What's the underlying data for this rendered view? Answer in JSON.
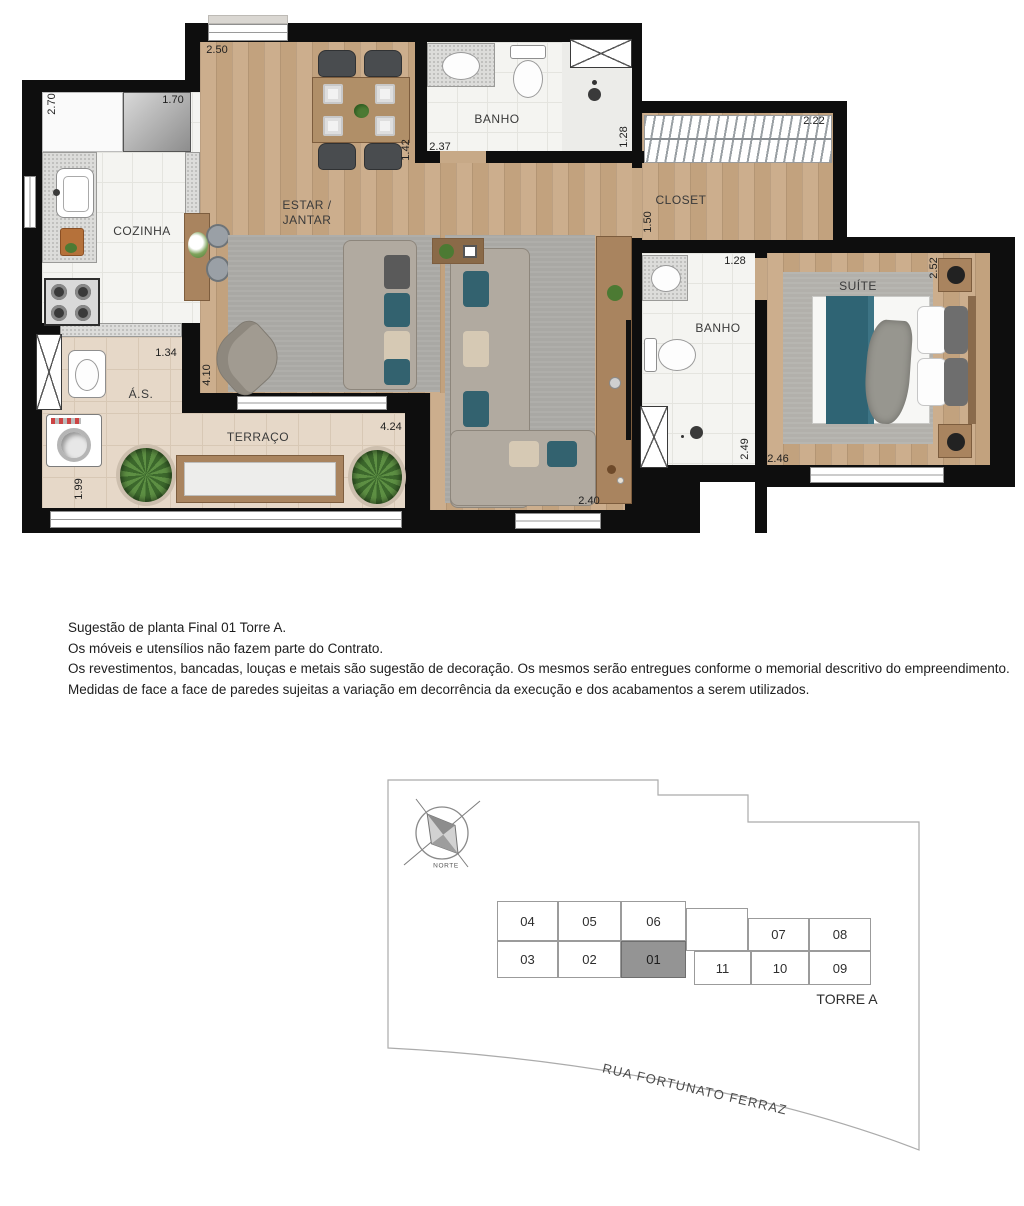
{
  "floor_plan": {
    "rooms": {
      "cozinha": "COZINHA",
      "estar_line1": "ESTAR /",
      "estar_line2": "JANTAR",
      "banho_social": "BANHO",
      "closet": "CLOSET",
      "banho_suite": "BANHO",
      "suite": "SUÍTE",
      "area_servico": "Á.S.",
      "terraco": "TERRAÇO"
    },
    "dimensions": {
      "estar_top": "2.50",
      "cozinha_left": "2.70",
      "cozinha_top": "1.70",
      "estar_right": "1.42",
      "banho_social_width": "2.37",
      "banho_social_depth": "1.28",
      "closet_width": "2.22",
      "closet_door": "1.50",
      "banho_suite_width": "1.28",
      "suite_depth": "2.52",
      "as_width": "1.34",
      "living_depth": "4.10",
      "terraco_width": "4.24",
      "living_width": "2.40",
      "banho_suite_depth": "2.49",
      "suite_width": "2.46",
      "terraco_depth": "1.99"
    },
    "colors": {
      "wall": "#0e0e0e",
      "wood_floor": "#c9ab89",
      "tile_floor": "#f4f4f1",
      "terrace_floor": "#e6d8c8",
      "rug": "#a9a8a4",
      "accent_teal": "#2f6474"
    }
  },
  "disclaimer": {
    "lines": [
      "Sugestão de planta Final 01 Torre A.",
      "Os móveis e utensílios não fazem parte do Contrato.",
      "Os revestimentos, bancadas, louças e metais são sugestão de decoração. Os mesmos serão entregues conforme o memorial descritivo do empreendimento.",
      "Medidas de face a face de paredes sujeitas a variação em decorrência da execução e dos acabamentos a serem utilizados."
    ]
  },
  "site_plan": {
    "compass": "NORTE",
    "tower": "TORRE A",
    "street": "RUA FORTUNATO FERRAZ",
    "highlighted_unit": "01",
    "highlight_color": "#949494",
    "units": [
      "04",
      "05",
      "06",
      "03",
      "02",
      "01",
      "07",
      "08",
      "11",
      "10",
      "09"
    ]
  }
}
